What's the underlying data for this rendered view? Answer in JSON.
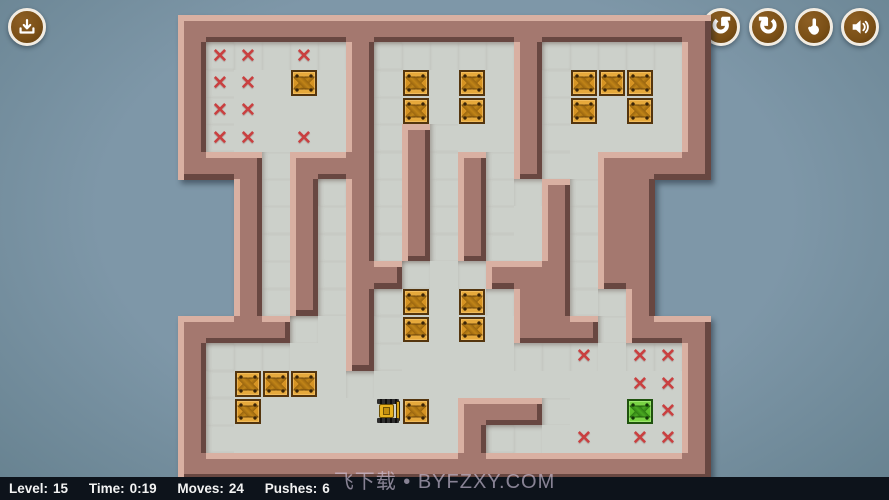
{
  "hud": {
    "level_label": "Level:",
    "level": "15",
    "time_label": "Time:",
    "time": "0:19",
    "moves_label": "Moves:",
    "moves": "24",
    "pushes_label": "Pushes:",
    "pushes": "6"
  },
  "watermark": "飞下载 • BYFZXY.COM",
  "toolbar": {
    "download": "download",
    "undo": "undo",
    "restart": "restart",
    "hint": "hint",
    "sound": "sound",
    "undo_glyph": "↺",
    "restart_glyph": "↻"
  },
  "board": {
    "cols": 19,
    "rows": 17,
    "map": [
      "###################",
      "#.....#.....#.....#",
      "#.....#.....#.....#",
      "#.....#.....#.....#",
      "#.....#.#...#.....#",
      "###.###.#.#.#..####",
      "  #.#.#.#.#..#.##  ",
      "  #.#.#.#.#..#.##  ",
      "  #.#.#.#.#..#.##  ",
      "  #.#.##...###.##  ",
      "  #.#.#.....##..#  ",
      "####..#.....###.###",
      "#.....#...........#",
      "#.................#",
      "#.........###.....#",
      "#.........#.......#",
      "###################"
    ],
    "crates": [
      [
        4,
        2
      ],
      [
        8,
        2
      ],
      [
        10,
        2
      ],
      [
        14,
        2
      ],
      [
        15,
        2
      ],
      [
        16,
        2
      ],
      [
        8,
        3
      ],
      [
        10,
        3
      ],
      [
        14,
        3
      ],
      [
        16,
        3
      ],
      [
        8,
        10
      ],
      [
        10,
        10
      ],
      [
        8,
        11
      ],
      [
        10,
        11
      ],
      [
        2,
        13
      ],
      [
        3,
        13
      ],
      [
        4,
        13
      ],
      [
        2,
        14
      ],
      [
        8,
        14
      ]
    ],
    "crates_on_target": [
      [
        16,
        14
      ]
    ],
    "targets": [
      [
        1,
        1
      ],
      [
        2,
        1
      ],
      [
        4,
        1
      ],
      [
        1,
        2
      ],
      [
        2,
        2
      ],
      [
        1,
        3
      ],
      [
        2,
        3
      ],
      [
        1,
        4
      ],
      [
        2,
        4
      ],
      [
        4,
        4
      ],
      [
        14,
        12
      ],
      [
        16,
        12
      ],
      [
        17,
        12
      ],
      [
        16,
        13
      ],
      [
        17,
        13
      ],
      [
        17,
        14
      ],
      [
        14,
        15
      ],
      [
        16,
        15
      ],
      [
        17,
        15
      ]
    ],
    "player": {
      "col": 7,
      "row": 14,
      "facing": "right"
    },
    "target_glyph": "✕"
  },
  "colors": {
    "wall": "#a4786f",
    "wall_light": "#d9b0a2",
    "wall_dark": "#684741",
    "floor": "#ccd0ca",
    "bg": "#7e97a8",
    "bg_edge": "#66818f",
    "crate": "#d79322",
    "green_crate": "#5cbf2d",
    "target": "#c94040",
    "button": "#7a4f16",
    "bar": "#0d131b"
  }
}
